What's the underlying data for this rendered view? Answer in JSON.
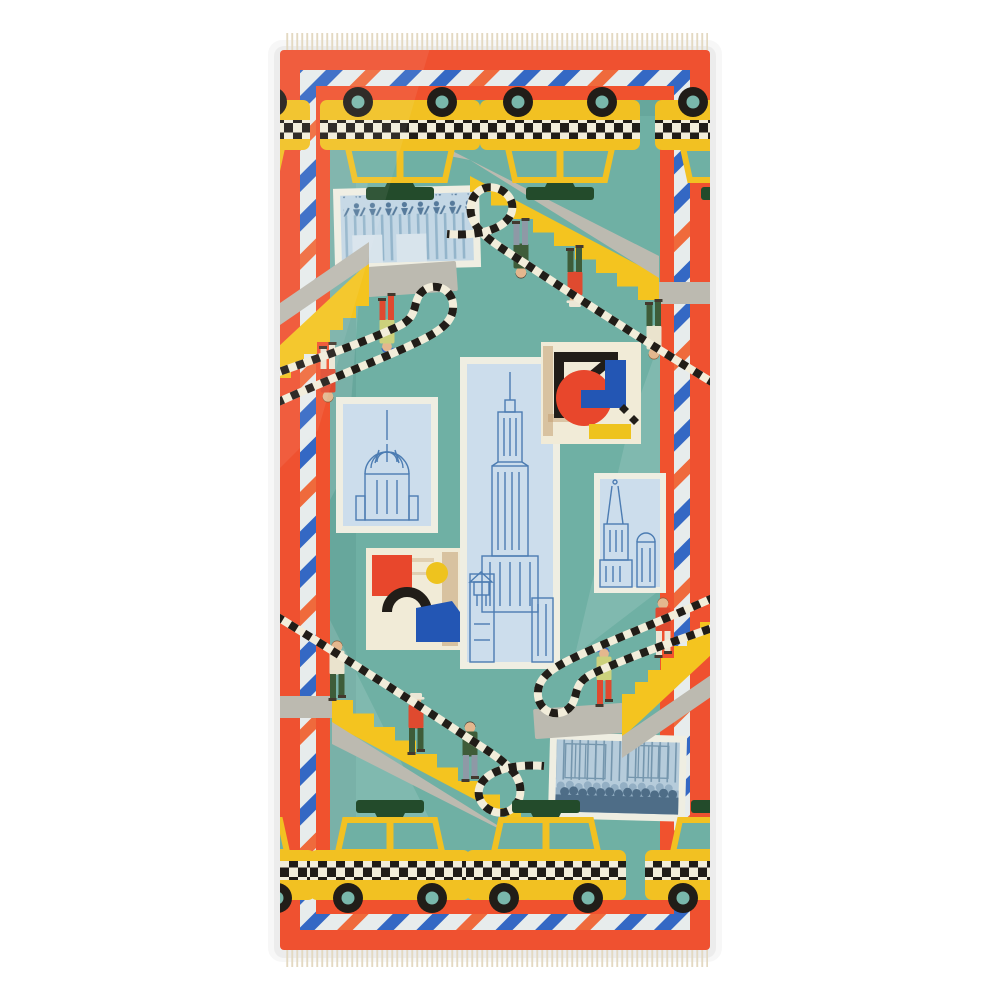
{
  "image_type": "product photograph",
  "subject": "Rectangular printed modal/wool scarf with a New York City theme laid flat on a white background",
  "scene": {
    "background": "plain white studio backdrop",
    "orientation": "vertical rectangle, design rotationally symmetric (top half is the bottom half turned 180 degrees)",
    "motifs": {
      "yellow_checker_taxis_top_row": 4,
      "yellow_checker_taxis_bottom_row": 4,
      "staircases_with_people": 4,
      "people_figures": 10,
      "checkered_ribbon_paths": 4,
      "art_panels": [
        "chorus-line-dancers print (top left, blue tones)",
        "chrysler-building line drawing (middle left)",
        "empire-state-building tall line drawing (center)",
        "abstract-collage with black angle, red circle, blue rectangles, yellow bar (upper right)",
        "abstract-collage with red square, yellow sun, black arch, blue pentagon (lower left)",
        "church-towers line drawing (middle right)",
        "street-crowd print (bottom right, blue tones)"
      ],
      "border": "red-orange band with diagonally striped blue/orange ribbon frame and inner red-orange frame",
      "fringe": "short cream fringe on top and bottom edges"
    }
  },
  "palette": {
    "photo_bg": "#ffffff",
    "orange": "#ef5130",
    "frame_orange": "#f0522e",
    "ribbon_white": "#e7ecec",
    "ribbon_blue": "#3468c4",
    "ribbon_orange": "#ef6a3c",
    "teal": "#6fb0a4",
    "teal_shade": "#5e9e93",
    "taxi_yellow": "#f2c122",
    "stair_yellow": "#f4c41f",
    "stair_gray": "#bcbab0",
    "sign_green": "#234b2b",
    "checker_white": "#f2edda",
    "black": "#211d18",
    "wheel_hub": "#79b7ab",
    "panel_border": "#efeee2",
    "panel_blue_bg": "#ccddec",
    "line_blue": "#4c7cb2",
    "cream": "#f1ebd7",
    "art_red": "#e8472c",
    "art_blue": "#2356b4",
    "art_yellow": "#eec31e",
    "tan": "#c09a6a",
    "skin": "#e4b78e",
    "hair_brown": "#8a5a38",
    "hair_dark": "#43392e",
    "p_cream": "#eae3cd",
    "p_red": "#df4a2f",
    "p_olive": "#ccd17c",
    "p_dkgreen": "#3e5c39",
    "p_slate": "#8e99a6",
    "p_white": "#ece7d6",
    "p_capblue": "#3f6fc0",
    "fringe": "#e3d9c2",
    "crowd_bg": "#b6ccdb",
    "crowd_dark": "#4e6d87",
    "crowd_mid": "#93afc4",
    "crowd_line": "#7596ad",
    "dancer_dark": "#567a9b",
    "dancer_bg": "#c3d7e5",
    "dancer_stripe": "#94b5cb"
  }
}
